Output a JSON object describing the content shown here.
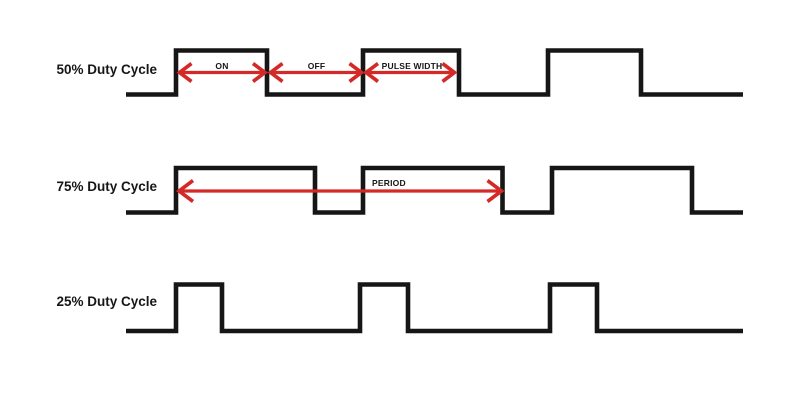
{
  "figure": {
    "description": "PWM duty cycle timing diagram",
    "background_color": "#ffffff",
    "waveform_color": "#161616",
    "waveform_stroke_width": 4.6,
    "arrow_color": "#d32a28",
    "arrow_line_width": 3.2,
    "arrow_head_width": 3.6,
    "text_color": "#161616"
  },
  "rows": [
    {
      "id": "50",
      "label": "50% Duty Cycle",
      "duty_percent": 50,
      "label_x": 157,
      "label_y": 74,
      "x_start": 126,
      "x_end": 743,
      "y_high": 50.5,
      "y_low": 94.5,
      "pulses": [
        [
          176,
          267
        ],
        [
          363,
          459
        ],
        [
          548,
          641
        ]
      ]
    },
    {
      "id": "75",
      "label": "75% Duty Cycle",
      "duty_percent": 75,
      "label_x": 157,
      "label_y": 191,
      "x_start": 126,
      "x_end": 743,
      "y_high": 168,
      "y_low": 212.5,
      "pulses": [
        [
          176,
          315
        ],
        [
          363,
          502.5
        ],
        [
          552,
          692
        ]
      ]
    },
    {
      "id": "25",
      "label": "25% Duty Cycle",
      "duty_percent": 25,
      "label_x": 157,
      "label_y": 306,
      "x_start": 126,
      "x_end": 743,
      "y_high": 284.5,
      "y_low": 331,
      "pulses": [
        [
          176,
          222
        ],
        [
          360,
          408
        ],
        [
          550,
          597
        ]
      ]
    }
  ],
  "annotations": [
    {
      "id": "on",
      "text": "ON",
      "x1": 179.5,
      "x2": 265,
      "y": 72.5,
      "label_x": 222,
      "label_y": 69,
      "anchor": "middle",
      "head_back": 12,
      "head_half": 9
    },
    {
      "id": "off",
      "text": "OFF",
      "x1": 270.5,
      "x2": 361.5,
      "y": 72.5,
      "label_x": 316.5,
      "label_y": 69,
      "anchor": "middle",
      "head_back": 12,
      "head_half": 9
    },
    {
      "id": "pulse-width",
      "text": "PULSE WIDTH",
      "x1": 366,
      "x2": 454.5,
      "y": 72.5,
      "label_x": 412,
      "label_y": 69,
      "anchor": "middle",
      "head_back": 12,
      "head_half": 9
    },
    {
      "id": "period",
      "text": "PERIOD",
      "x1": 179,
      "x2": 501.5,
      "y": 191,
      "label_x": 372,
      "label_y": 186,
      "anchor": "start",
      "head_back": 14,
      "head_half": 10.5
    }
  ]
}
